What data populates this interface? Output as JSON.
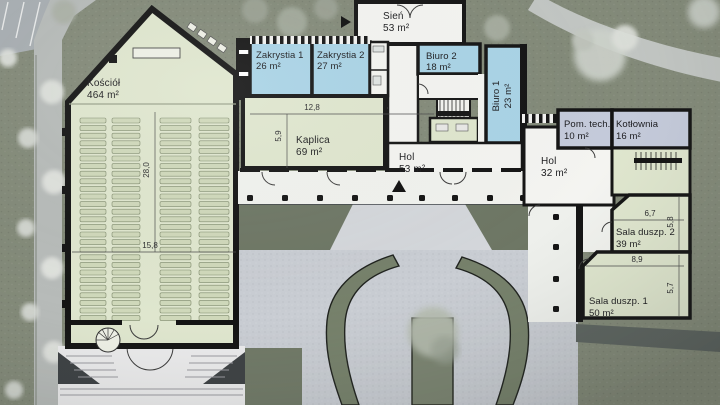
{
  "plan": {
    "rooms": {
      "kosciol": {
        "name": "Kościół",
        "area": "464 m²"
      },
      "zakrystia1": {
        "name": "Zakrystia 1",
        "area": "26 m²"
      },
      "zakrystia2": {
        "name": "Zakrystia 2",
        "area": "27 m²"
      },
      "sien": {
        "name": "Sień",
        "area": "53 m²"
      },
      "biuro2": {
        "name": "Biuro 2",
        "area": "18 m²"
      },
      "biuro1": {
        "name": "Biuro 1",
        "area": "23 m²"
      },
      "kaplica": {
        "name": "Kaplica",
        "area": "69 m²"
      },
      "hol1": {
        "name": "Hol",
        "area": "53 m²"
      },
      "hol2": {
        "name": "Hol",
        "area": "32 m²"
      },
      "pomtech": {
        "name": "Pom. tech.",
        "area": "10 m²"
      },
      "kotlownia": {
        "name": "Kotłownia",
        "area": "16 m²"
      },
      "sala2": {
        "name": "Sala duszp. 2",
        "area": "39 m²"
      },
      "sala1": {
        "name": "Sala duszp. 1",
        "area": "50 m²"
      }
    },
    "dimensions": {
      "church_length": "28,0",
      "church_width": "15,8",
      "kaplica_width": "12,8",
      "kaplica_depth": "5,9",
      "sala2_width": "6,7",
      "sala2_depth": "5,8",
      "sala1_width": "8,9",
      "sala1_depth": "5,7"
    },
    "colors": {
      "room_green": "#dfe6ce",
      "room_blue": "#a9d3e6",
      "room_lavender": "#c4cada",
      "room_white": "#f4f4f1",
      "wall": "#141414",
      "lawn": "#838a79",
      "paving": "#c9cdd3",
      "path": "#c2c6c3",
      "hedge": "#76816b"
    }
  }
}
